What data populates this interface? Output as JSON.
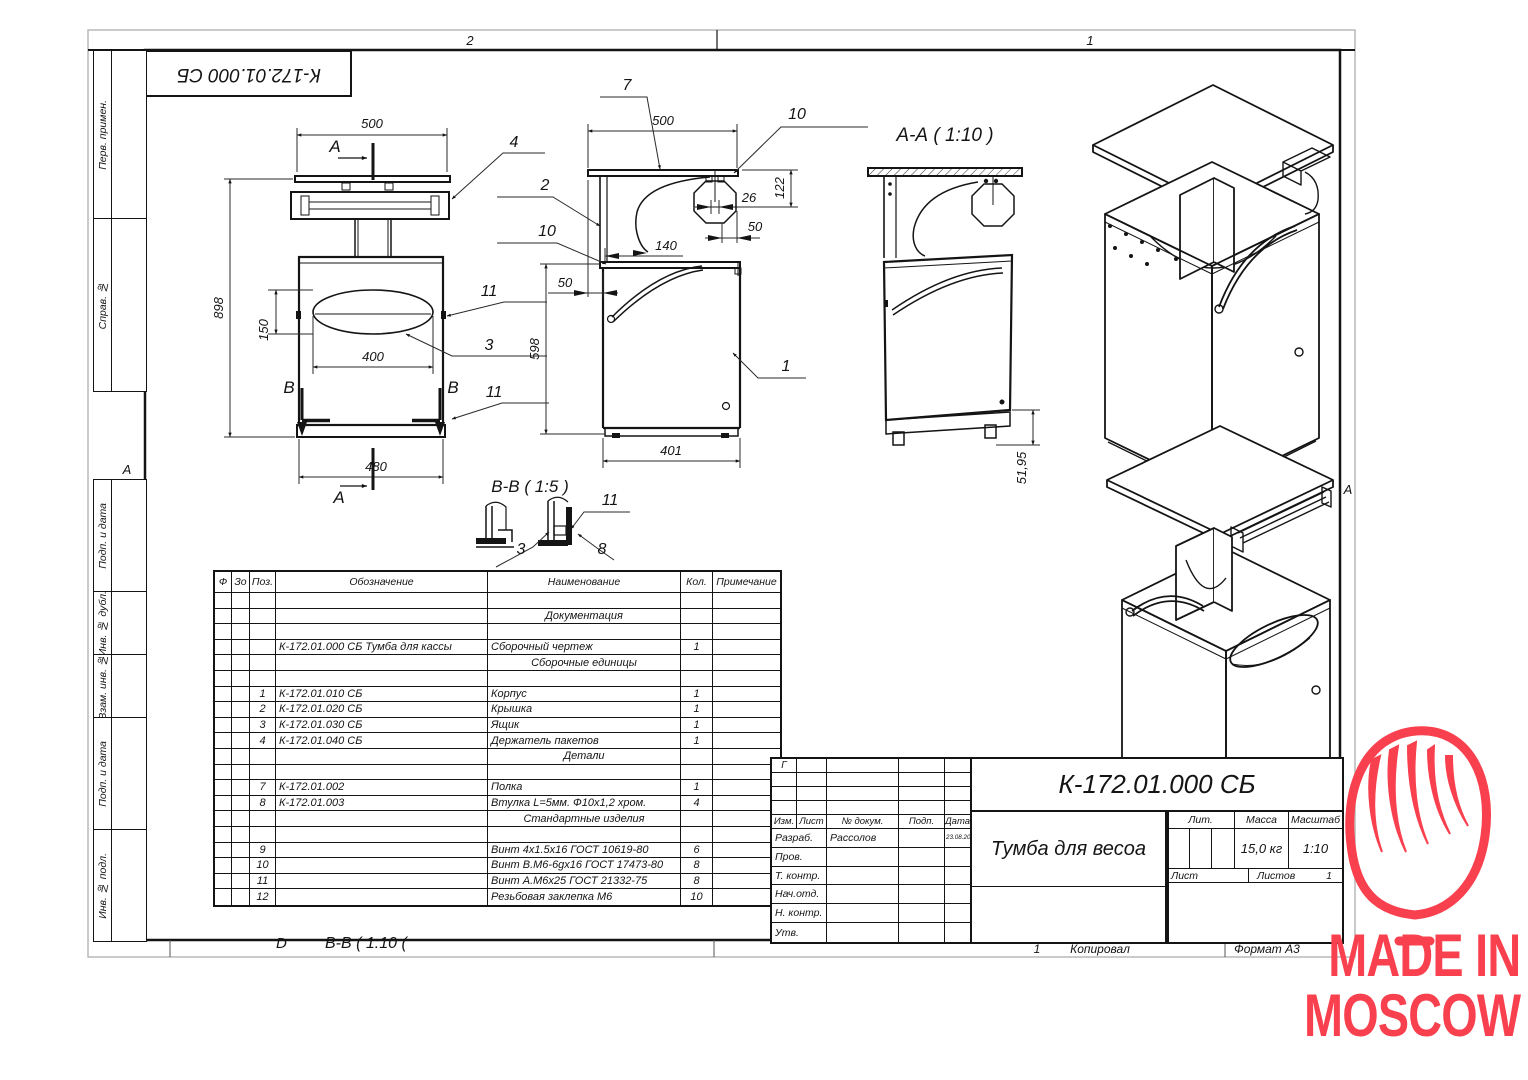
{
  "sheet": {
    "format_zones": {
      "left": "2",
      "right": "1"
    },
    "fold_marker": "А",
    "stamp_top": "К-172.01.000 СБ",
    "sidebar_labels": [
      "Перв. примен.",
      "Справ. №",
      "Подп. и дата",
      "Инв. № дубл.",
      "Взам. инв. №",
      "Подп. и дата",
      "Инв. № подл."
    ],
    "bottom": {
      "sheet_no": "1",
      "copied_label": "Копировал",
      "format_label": "Формат А3",
      "note_d": "D",
      "note_view": "В-В ( 1:10 ("
    }
  },
  "views": {
    "front": {
      "dims": {
        "top_width": "500",
        "total_height": "898",
        "cutout_height": "150",
        "cutout_width": "400",
        "bottom_width": "480"
      },
      "section_a": "А",
      "section_b": "В",
      "callouts": {
        "bag_holder": "4",
        "screw_top": "11",
        "drawer": "3",
        "screw_bottom": "11"
      }
    },
    "side": {
      "dims": {
        "top_width": "500",
        "roll_drop": "122",
        "roll_core": "26",
        "roll_offset": "50",
        "bag_width": "140",
        "top_overhang": "50",
        "body_height": "598",
        "body_depth": "401"
      },
      "callouts": {
        "top_panel": "7",
        "roll_top": "10",
        "cover": "2",
        "roll_left": "10",
        "body": "1"
      }
    },
    "section_aa": {
      "title": "А-А ( 1:10 )",
      "dims": {
        "base_height": "51,95"
      }
    },
    "detail_bb": {
      "title": "В-В ( 1:5 )",
      "callouts": {
        "screw": "11",
        "drawer": "3",
        "bushing": "8"
      }
    }
  },
  "spec_table": {
    "headers": [
      "Ф",
      "Зо",
      "Поз.",
      "Обозначение",
      "Наименование",
      "Кол.",
      "Примечание"
    ],
    "rows": [
      {
        "pos": "",
        "designation": "",
        "name": "",
        "qty": ""
      },
      {
        "pos": "",
        "designation": "",
        "name": "Документация",
        "qty": "",
        "cls": "center"
      },
      {
        "pos": "",
        "designation": "",
        "name": "",
        "qty": ""
      },
      {
        "pos": "",
        "designation": "К-172.01.000 СБ Тумба для кассы",
        "name": "Сборочный чертеж",
        "qty": "1"
      },
      {
        "pos": "",
        "designation": "",
        "name": "Сборочные единицы",
        "qty": "",
        "cls": "center"
      },
      {
        "pos": "",
        "designation": "",
        "name": "",
        "qty": ""
      },
      {
        "pos": "1",
        "designation": "К-172.01.010 СБ",
        "name": "Корпус",
        "qty": "1"
      },
      {
        "pos": "2",
        "designation": "К-172.01.020 СБ",
        "name": "Крышка",
        "qty": "1"
      },
      {
        "pos": "3",
        "designation": "К-172.01.030 СБ",
        "name": "Ящик",
        "qty": "1"
      },
      {
        "pos": "4",
        "designation": "К-172.01.040 СБ",
        "name": "Держатель пакетов",
        "qty": "1"
      },
      {
        "pos": "",
        "designation": "",
        "name": "Детали",
        "qty": "",
        "cls": "center"
      },
      {
        "pos": "",
        "designation": "",
        "name": "",
        "qty": ""
      },
      {
        "pos": "7",
        "designation": "К-172.01.002",
        "name": "Полка",
        "qty": "1"
      },
      {
        "pos": "8",
        "designation": "К-172.01.003",
        "name": "Втулка L=5мм. Ф10х1,2 хром.",
        "qty": "4"
      },
      {
        "pos": "",
        "designation": "",
        "name": "Стандартные изделия",
        "qty": "",
        "cls": "center"
      },
      {
        "pos": "",
        "designation": "",
        "name": "",
        "qty": ""
      },
      {
        "pos": "9",
        "designation": "",
        "name": "Винт 4х1.5х16 ГОСТ 10619-80",
        "qty": "6"
      },
      {
        "pos": "10",
        "designation": "",
        "name": "Винт В.М6-6gх16 ГОСТ 17473-80",
        "qty": "8"
      },
      {
        "pos": "11",
        "designation": "",
        "name": "Винт А.М6х25 ГОСТ 21332-75",
        "qty": "8"
      },
      {
        "pos": "12",
        "designation": "",
        "name": "Резьбовая заклепка М6",
        "qty": "10"
      }
    ]
  },
  "title_block": {
    "doc_number": "К-172.01.000 СБ",
    "product_title": "Тумба для весоа",
    "rev_mark": "Г",
    "columns": [
      "Изм.",
      "Лист",
      "№ докум.",
      "Подп.",
      "Дата"
    ],
    "sig_rows": [
      {
        "role": "Разраб.",
        "name": "Рассолов",
        "date": "23.08.2021"
      },
      {
        "role": "Пров.",
        "name": "",
        "date": ""
      },
      {
        "role": "Т. контр.",
        "name": "",
        "date": ""
      },
      {
        "role": "Нач.отд.",
        "name": "",
        "date": ""
      },
      {
        "role": "Н. контр.",
        "name": "",
        "date": ""
      },
      {
        "role": "Утв.",
        "name": "",
        "date": ""
      }
    ],
    "lit_label": "Лит.",
    "mass_label": "Масса",
    "scale_label": "Масштаб",
    "mass_value": "15,0 кг",
    "scale_value": "1:10",
    "sheet_label": "Лист",
    "sheets_label": "Листов",
    "sheets_value": "1"
  },
  "logo": {
    "line1": "MADE IN",
    "line2": "MOSCOW",
    "color": "#f9404e"
  }
}
